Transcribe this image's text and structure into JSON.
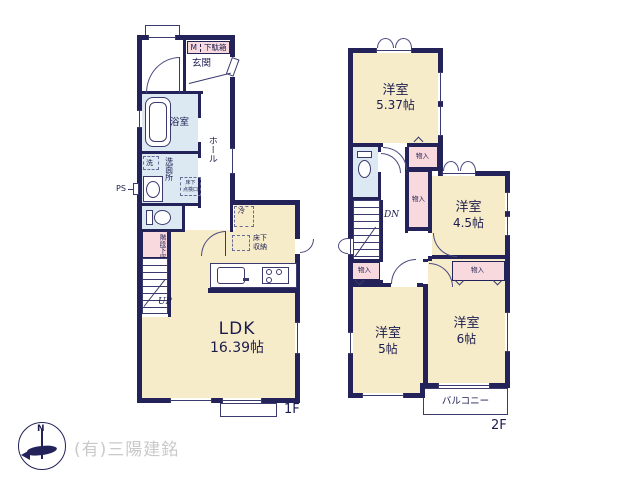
{
  "floor1": {
    "label": "1F",
    "entrance": "玄関",
    "meter": "M",
    "shoe_box": "下駄箱",
    "bathroom": "浴室",
    "hall": "ホール",
    "laundry": "洗",
    "washroom": "洗面所",
    "hatch_line1": "床下",
    "hatch_line2": "点検口",
    "pipe_space": "PS",
    "under_stair_storage": "階段下収納",
    "fridge": "冷",
    "floor_storage_line1": "床下",
    "floor_storage_line2": "収納",
    "ldk_name": "LDK",
    "ldk_size": "16.39帖",
    "up": "UP"
  },
  "floor2": {
    "label": "2F",
    "western_room": "洋室",
    "room_537_size": "5.37帖",
    "room_45_size": "4.5帖",
    "room_5_size": "5帖",
    "room_6_size": "6帖",
    "closet": "物入",
    "down": "DN",
    "balcony": "バルコニー"
  },
  "footer": {
    "compass_north": "N",
    "company": "(有)三陽建銘"
  },
  "colors": {
    "wall": "#23235a",
    "room_fill": "#f7ecca",
    "wet_area_fill": "#dce9f3",
    "closet_fill": "#f8d9de",
    "text": "#1c1c4e",
    "watermark": "#c9c9c9"
  }
}
